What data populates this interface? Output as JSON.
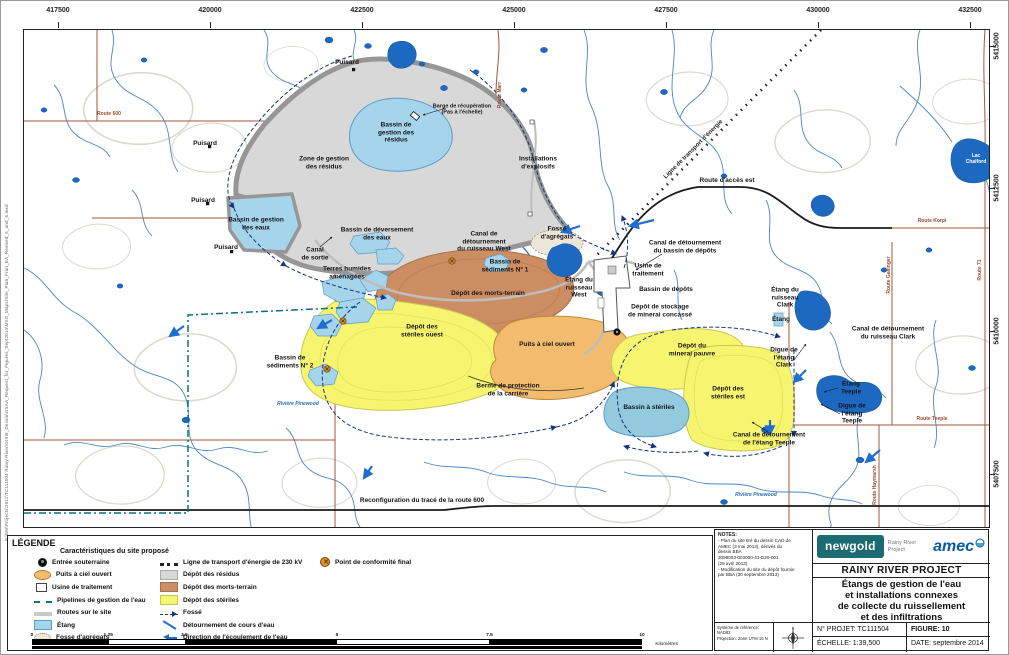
{
  "colors": {
    "tailings_gray": "#d8d8d8",
    "overburden_brown": "#cd8d62",
    "waste_rock_yellow": "#f7f570",
    "open_pit_orange": "#f3bb6d",
    "pond_light": "#a6d4ea",
    "pond_dark": "#1d69c2",
    "pipeline_teal": "#0d7080",
    "ditch_navy": "#16357e",
    "flow_blue": "#1f6fd0",
    "conformity_orange": "#e8921e",
    "road_red": "#a5553a",
    "newgold_teal": "#1b6b70",
    "amec_blue": "#0a5aa0"
  },
  "margin": {
    "filepath": "P:\\EM\\Projects\\2011\\TC111504 Rainy River\\GIS\\8_Dessin\\GSAA_Request_for_Figures_Sept2014\\MXD_Maps\\Site_Plan_Fran_EA_Revised_5_and_6.mxd"
  },
  "grid": {
    "top": [
      {
        "v": "417500",
        "x": 35
      },
      {
        "v": "420000",
        "x": 187
      },
      {
        "v": "422500",
        "x": 339
      },
      {
        "v": "425000",
        "x": 491
      },
      {
        "v": "427500",
        "x": 643
      },
      {
        "v": "430000",
        "x": 795
      },
      {
        "v": "432500",
        "x": 947
      }
    ],
    "right": [
      {
        "v": "5415000",
        "y": 17
      },
      {
        "v": "5412500",
        "y": 159
      },
      {
        "v": "5410000",
        "y": 302
      },
      {
        "v": "5407500",
        "y": 445
      }
    ]
  },
  "map": {
    "labels": [
      {
        "t": "Puisard",
        "x": 323,
        "y": 33
      },
      {
        "t": "Puisard",
        "x": 181,
        "y": 114
      },
      {
        "t": "Puisard",
        "x": 179,
        "y": 171
      },
      {
        "t": "Puisard",
        "x": 202,
        "y": 218
      },
      {
        "t": "Barge de récupération\n(Pas à l'échelle)",
        "x": 438,
        "y": 80,
        "cls": "small"
      },
      {
        "t": "Bassin de\ngestion des\nrésidus",
        "x": 372,
        "y": 103
      },
      {
        "t": "Zone de gestion\ndes résidus",
        "x": 300,
        "y": 133
      },
      {
        "t": "Bassin de gestion\ndes eaux",
        "x": 232,
        "y": 194
      },
      {
        "t": "Bassin de déversement\ndes eaux",
        "x": 353,
        "y": 204
      },
      {
        "t": "Canal\nde sortie",
        "x": 291,
        "y": 224
      },
      {
        "t": "Terres humides\naménagées",
        "x": 323,
        "y": 243
      },
      {
        "t": "Canal de\ndétournement\ndu ruisseau West",
        "x": 460,
        "y": 212
      },
      {
        "t": "Fosse\nd'agrégats",
        "x": 533,
        "y": 203
      },
      {
        "t": "Bassin de\nsédiments N° 1",
        "x": 481,
        "y": 236
      },
      {
        "t": "Dépôt des morts-terrain",
        "x": 464,
        "y": 264
      },
      {
        "t": "Dépôt des\nstériles ouest",
        "x": 398,
        "y": 301
      },
      {
        "t": "Bassin de\nsédiments N° 2",
        "x": 266,
        "y": 332
      },
      {
        "t": "Puits à ciel ouvert",
        "x": 523,
        "y": 315
      },
      {
        "t": "Berme de protection\nde la carrière",
        "x": 484,
        "y": 360
      },
      {
        "t": "Étang du\nruisseau\nWest",
        "x": 555,
        "y": 258
      },
      {
        "t": "Canal de détournement\ndu bassin de dépôts",
        "x": 661,
        "y": 217
      },
      {
        "t": "Usine de\ntraitement",
        "x": 624,
        "y": 240
      },
      {
        "t": "Bassin de dépôts",
        "x": 642,
        "y": 260
      },
      {
        "t": "Dépôt de stockage\nde minerai concassé",
        "x": 636,
        "y": 281
      },
      {
        "t": "Dépôt du\nminerai pauvre",
        "x": 668,
        "y": 320
      },
      {
        "t": "Dépôt des\nstériles est",
        "x": 704,
        "y": 363
      },
      {
        "t": "Bassin à stériles",
        "x": 625,
        "y": 378
      },
      {
        "t": "Étang du\nruisseau\nClark",
        "x": 761,
        "y": 268
      },
      {
        "t": "Étang",
        "x": 757,
        "y": 290
      },
      {
        "t": "Canal de détournement\ndu ruisseau Clark",
        "x": 864,
        "y": 303
      },
      {
        "t": "Digue de\nl'étang\nClark",
        "x": 760,
        "y": 328
      },
      {
        "t": "Étang\nTeeple",
        "x": 827,
        "y": 358
      },
      {
        "t": "Digue de\nl'étang\nTeeple",
        "x": 828,
        "y": 384
      },
      {
        "t": "Canal de détournement\nde l'étang Teeple",
        "x": 745,
        "y": 409
      },
      {
        "t": "Installations\nd'explosifs",
        "x": 514,
        "y": 133
      },
      {
        "t": "Route d'accès est",
        "x": 703,
        "y": 151,
        "cls": "road"
      },
      {
        "t": "Reconfiguration du tracé de la route 600",
        "x": 398,
        "y": 471,
        "cls": "road"
      },
      {
        "t": "Rivière Pinewood",
        "x": 274,
        "y": 375,
        "cls": "lbl-blue"
      },
      {
        "t": "Rivière Pinewood",
        "x": 732,
        "y": 466,
        "cls": "lbl-blue"
      },
      {
        "t": "Lac\nChalford",
        "x": 952,
        "y": 130,
        "cls": "lbl-white"
      },
      {
        "t": "Route 600",
        "x": 85,
        "y": 85,
        "cls": "lbl-red"
      },
      {
        "t": "Route Marr",
        "x": 477,
        "y": 65,
        "cls": "lbl-red",
        "rot": -90
      },
      {
        "t": "Route Korpi",
        "x": 908,
        "y": 192,
        "cls": "lbl-red"
      },
      {
        "t": "Route Gallinger",
        "x": 866,
        "y": 245,
        "cls": "lbl-red",
        "rot": -90
      },
      {
        "t": "Route 71",
        "x": 957,
        "y": 240,
        "cls": "lbl-red",
        "rot": -90
      },
      {
        "t": "Route Teeple",
        "x": 908,
        "y": 390,
        "cls": "lbl-red"
      },
      {
        "t": "Route Haymarsh",
        "x": 852,
        "y": 455,
        "cls": "lbl-red",
        "rot": -90
      },
      {
        "t": "Ligne de transport d'énergie",
        "x": 670,
        "y": 120,
        "cls": "pwr",
        "rot": -45
      }
    ]
  },
  "legend": {
    "title": "LÉGENDE",
    "subtitle": "Caractéristiques du site proposé",
    "columns": [
      [
        {
          "icon": "entree",
          "label": "Entrée souterraine"
        },
        {
          "icon": "puits",
          "label": "Puits à ciel ouvert"
        },
        {
          "icon": "usine",
          "label": "Usine de traitement"
        },
        {
          "icon": "pipeline",
          "label": "Pipelines de gestion de l'eau"
        },
        {
          "icon": "route",
          "label": "Routes sur le site"
        },
        {
          "icon": "etang",
          "label": "Étang"
        },
        {
          "icon": "fosseagg",
          "label": "Fosse d'agrégats"
        }
      ],
      [
        {
          "icon": "ligne230",
          "label": "Ligne de transport d'énergie de 230 kV"
        },
        {
          "icon": "residus",
          "label": "Dépôt des résidus"
        },
        {
          "icon": "morts",
          "label": "Dépôt des morts-terrain"
        },
        {
          "icon": "steriles",
          "label": "Dépôt des stériles"
        },
        {
          "icon": "fosse",
          "label": "Fossé"
        },
        {
          "icon": "detour",
          "label": "Détournement de cours d'eau"
        },
        {
          "icon": "ecoul",
          "label": "Direction de l'écoulement de l'eau"
        }
      ],
      [
        {
          "icon": "conform",
          "label": "Point de conformité final"
        }
      ]
    ]
  },
  "scalebar": {
    "ticks": [
      {
        "v": "0",
        "p": 0
      },
      {
        "v": "1.25",
        "p": 12.5
      },
      {
        "v": "2.5",
        "p": 25
      },
      {
        "v": "5",
        "p": 50
      },
      {
        "v": "7.5",
        "p": 75
      },
      {
        "v": "10",
        "p": 100
      }
    ],
    "unit": "Kilomètres"
  },
  "titleblock": {
    "notes_title": "NOTES:",
    "notes": [
      "- Plan du site tiré du dessin CAD de",
      "  AMEC (3 mai 2013), dérivés du",
      "  dessin BBA",
      "  3098003-003000-41-D20-001",
      "  (29 avril 2013)",
      "- Modification du site du dépôt fournie",
      "  par BBA (30 septembre 2013)"
    ],
    "reference": "Système de référence: NAD83\nProjection: Zone UTM 15 N",
    "brand_newgold": "newgold",
    "brand_project": "Rainy River Project",
    "brand_amec": "amec",
    "project_title": "RAINY RIVER PROJECT",
    "figure_title": "Étangs de gestion de l'eau\net installations connexes\nde collecte du ruissellement\net des infiltrations",
    "projet": "N° PROJET: TC111504",
    "figure": "FIGURE: 10",
    "echelle": "ÉCHELLE: 1:39,500",
    "date": "DATE: septembre 2014"
  }
}
